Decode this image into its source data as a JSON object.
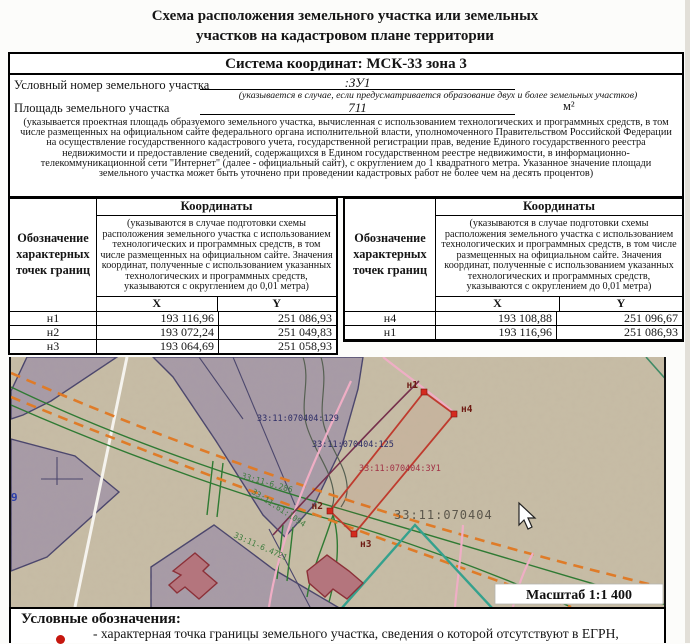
{
  "document": {
    "title_line1": "Схема расположения земельного участка или земельных",
    "title_line2": "участков на кадастровом плане территории",
    "coordinate_system": "Система координат: МСК-33 зона 3",
    "conditional_number": {
      "label": "Условный номер земельного участка",
      "value": ":ЗУ1",
      "note": "(указывается в случае, если предусматривается образование двух и более земельных участков)"
    },
    "area": {
      "label": "Площадь земельного участка",
      "value": "711",
      "unit": "м²",
      "note": "(указывается проектная площадь образуемого земельного участка, вычисленная с использованием технологических и программных средств, в том числе размещенных на официальном сайте федерального органа исполнительной власти, уполномоченного Правительством Российской Федерации на осуществление государственного кадастрового учета, государственной регистрации прав, ведение Единого государственного реестра недвижимости и предоставление сведений, содержащихся в Едином государственном реестре недвижимости, в информационно-телекоммуникационной сети \"Интернет\" (далее - официальный сайт), с округлением до 1 квадратного метра. Указанное значение площади земельного участка может быть уточнено при проведении кадастровых работ не более чем на десять процентов)"
    }
  },
  "coordinates_table": {
    "point_header": "Обозначение характерных точек границ",
    "coords_header": "Координаты",
    "coords_note": "(указываются в случае подготовки схемы расположения земельного участка с использованием технологических и программных средств, в том числе размещенных на официальном сайте. Значения координат, полученные с использованием указанных технологических и программных средств, указываются с округлением до 0,01 метра)",
    "x_header": "X",
    "y_header": "Y",
    "left_rows": [
      {
        "point": "н1",
        "x": "193 116,96",
        "y": "251 086,93"
      },
      {
        "point": "н2",
        "x": "193 072,24",
        "y": "251 049,83"
      },
      {
        "point": "н3",
        "x": "193 064,69",
        "y": "251 058,93"
      }
    ],
    "right_rows": [
      {
        "point": "н4",
        "x": "193 108,88",
        "y": "251 096,67"
      },
      {
        "point": "н1",
        "x": "193 116,96",
        "y": "251 086,93"
      }
    ]
  },
  "map": {
    "scale_label": "Масштаб 1:1 400",
    "parcel_labels": {
      "p129": "33:11:070404:129",
      "p125": "33:11:070404:125",
      "zu1": "33:11:070404:ЗУ1",
      "quarter": "33:11:070404",
      "g1": "33:11-6.286",
      "g2": "33:11:61:1094",
      "g3": "33:11-6.4721",
      "blue9": "9"
    },
    "point_labels": {
      "n1": "н1",
      "n2": "н2",
      "n3": "н3",
      "n4": "н4"
    }
  },
  "legend": {
    "heading": "Условные обозначения:",
    "item1": "- характерная точка границы земельного участка, сведения о которой отсутствуют в ЕГРН,"
  },
  "colors": {
    "map_background": "#c8bda6",
    "parcel_fill": "#a79aa7",
    "parcel_stroke": "#45406a",
    "road_dashed": "#df7b28",
    "road_green": "#2f7a33",
    "plot_red": "#bf3b2e",
    "marker_red": "#d42a1e",
    "pink_line": "#efaec5",
    "teal_line": "#35a18d",
    "building_fill": "#b4757d",
    "label_navy": "#2c2c66",
    "label_red": "#a13246",
    "label_green": "#3f7d3f"
  }
}
